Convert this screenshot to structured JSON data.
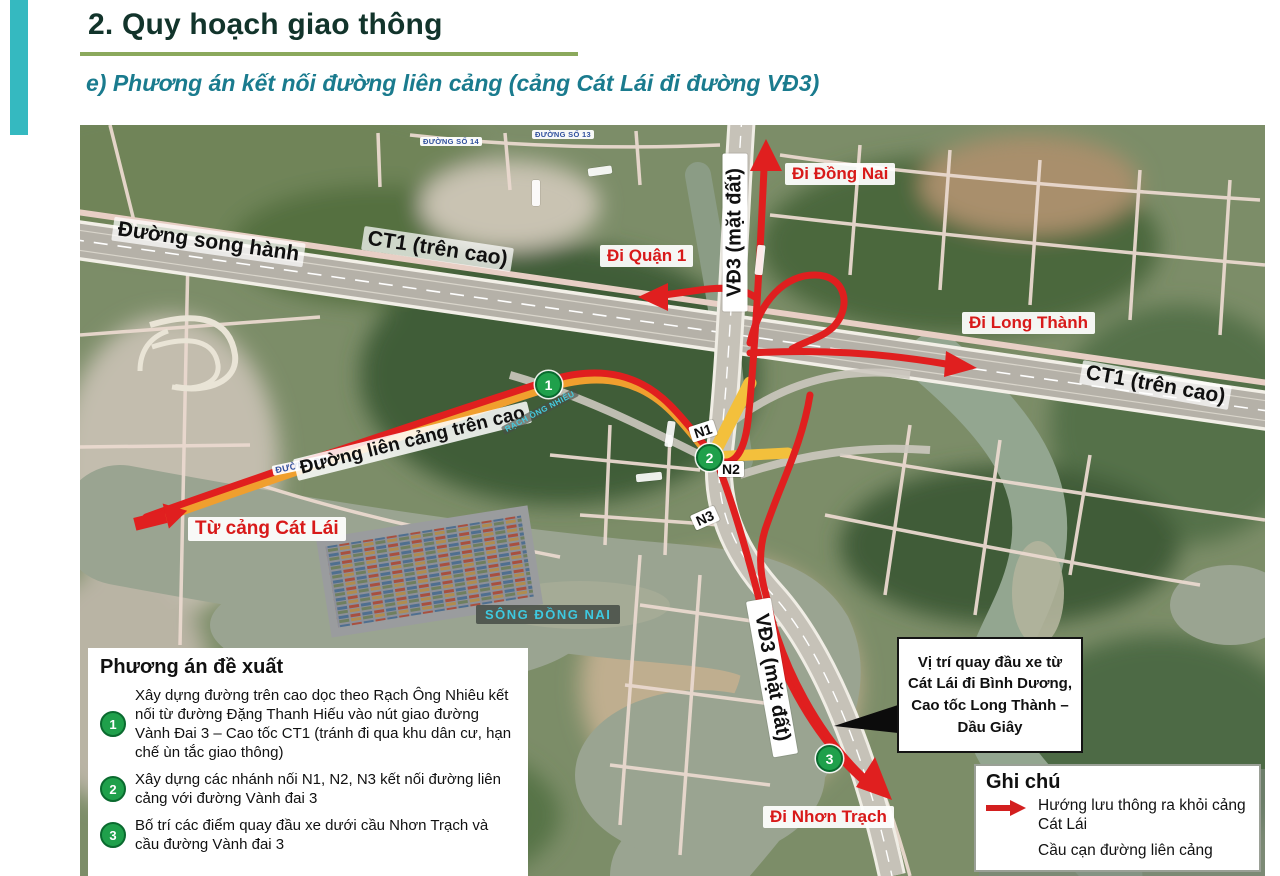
{
  "page": {
    "title": "2. Quy hoạch giao thông",
    "subtitle": "e) Phương án kết nối đường liên cảng (cảng Cát Lái đi đường VĐ3)"
  },
  "map": {
    "road_labels": {
      "song_hanh": "Đường song hành",
      "ct1_a": "CT1 (trên cao)",
      "ct1_b": "CT1 (trên cao)",
      "vd3_top": "VĐ3 (mặt đất)",
      "vd3_bottom": "VĐ3 (mặt đất)",
      "lien_cang": "Đường liên cảng trên cao"
    },
    "direction_labels": {
      "di_dong_nai": "Đi Đồng Nai",
      "di_quan_1": "Đi Quận 1",
      "di_long_thanh": "Đi Long Thành",
      "di_nhon_trach": "Đi Nhơn Trạch",
      "tu_cang_cat_lai": "Từ cảng Cát Lái"
    },
    "water_labels": {
      "song_dong_nai": "SÔNG ĐỒNG NAI",
      "rach_ong_nhieu": "RẠCH ÔNG NHIÊU"
    },
    "basemap_pills": {
      "duong_so_14": "ĐƯỜNG SỐ 14",
      "duong_so_13": "ĐƯỜNG SỐ 13",
      "duong_d3": "ĐƯỜNG D3"
    },
    "nodes": {
      "n1": "N1",
      "n2": "N2",
      "n3": "N3"
    },
    "markers": [
      "1",
      "2",
      "3"
    ],
    "callout": "Vị trí quay đầu xe từ Cát Lái đi Bình Dương, Cao tốc Long Thành – Dầu Giây"
  },
  "proposal": {
    "title": "Phương án đề xuất",
    "items": [
      {
        "num": "1",
        "text": "Xây dựng đường trên cao dọc theo Rạch Ông Nhiêu kết nối từ đường Đặng Thanh Hiếu vào nút giao đường Vành Đai 3 – Cao tốc CT1 (tránh đi qua khu dân cư, hạn chế ùn tắc giao thông)"
      },
      {
        "num": "2",
        "text": "Xây dựng các nhánh nối N1, N2, N3 kết nối đường liên cảng với đường Vành đai 3"
      },
      {
        "num": "3",
        "text": "Bố trí các điểm quay đầu xe dưới cầu Nhơn Trạch và cầu đường Vành đai 3"
      }
    ]
  },
  "legend": {
    "title": "Ghi chú",
    "items": [
      {
        "icon": "red-arrow",
        "text": "Hướng lưu thông ra khỏi cảng Cát Lái"
      },
      {
        "icon": "yellow-bar",
        "text": "Cầu cạn đường liên cảng"
      }
    ]
  },
  "colors": {
    "route_red": "#e01f1f",
    "viaduct_yellow": "#f3c03c",
    "marker_green": "#1fa04b",
    "accent_teal": "#35b9c0",
    "title_green": "#12342b",
    "subtitle_teal": "#1a7b8e",
    "rule_olive": "#8ba95c",
    "river_label_cyan": "#3ec9e0"
  }
}
